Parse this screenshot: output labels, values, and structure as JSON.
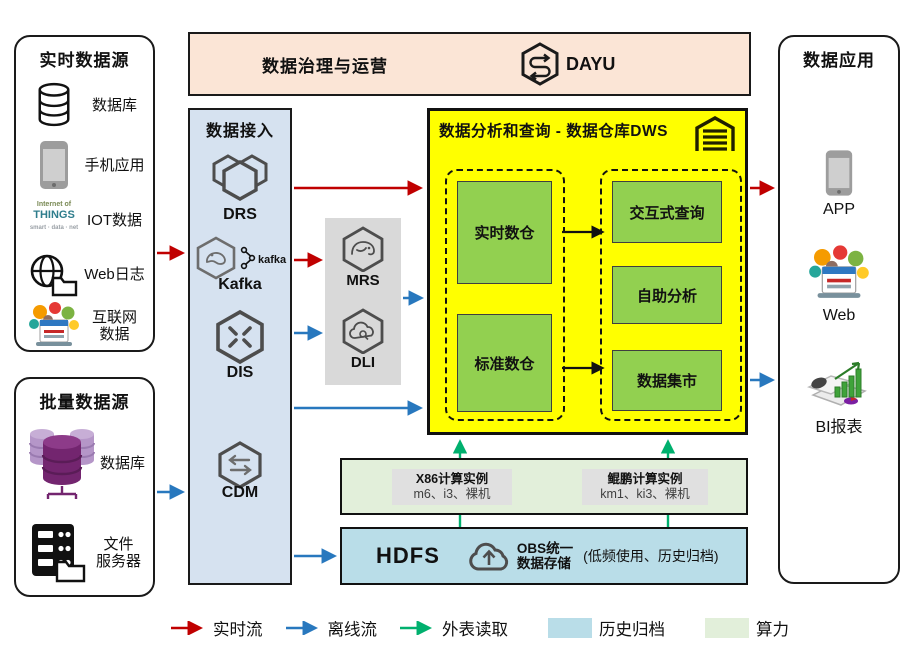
{
  "colors": {
    "realtime_flow": "#c00000",
    "offline_flow": "#2878be",
    "external_read": "#00b06e",
    "archive_fill": "#b9dde8",
    "compute_fill": "#e2efda",
    "dws_fill": "#ffff00",
    "warehouse_green": "#92d050",
    "ingestion_fill": "#d6e2f0",
    "banner_fill": "#fbe5d6",
    "processing_fill": "#d9d9d9"
  },
  "realtime_sources": {
    "title": "实时数据源",
    "items": [
      {
        "icon": "database-icon",
        "label": "数据库"
      },
      {
        "icon": "mobile-phone-icon",
        "label": "手机应用"
      },
      {
        "icon": "iot-wordcloud-icon",
        "label": "IOT数据"
      },
      {
        "icon": "globe-folder-icon",
        "label": "Web日志"
      },
      {
        "icon": "internet-collage-icon",
        "label_line1": "互联网",
        "label_line2": "数据"
      }
    ]
  },
  "batch_sources": {
    "title": "批量数据源",
    "items": [
      {
        "icon": "purple-database-cluster-icon",
        "label": "数据库"
      },
      {
        "icon": "file-server-icon",
        "label_line1": "文件",
        "label_line2": "服务器"
      }
    ]
  },
  "governance": {
    "title": "数据治理与运营",
    "product": "DAYU"
  },
  "ingestion": {
    "title": "数据接入",
    "services": [
      {
        "name": "DRS"
      },
      {
        "name": "Kafka",
        "badge": "kafka"
      },
      {
        "name": "DIS"
      },
      {
        "name": "CDM"
      }
    ]
  },
  "processing": {
    "services": [
      {
        "name": "MRS"
      },
      {
        "name": "DLI"
      }
    ]
  },
  "dws": {
    "title": "数据分析和查询 - 数据仓库DWS",
    "warehouses": [
      "实时数仓",
      "标准数仓"
    ],
    "services": [
      "交互式查询",
      "自助分析",
      "数据集市"
    ]
  },
  "applications": {
    "title": "数据应用",
    "items": [
      {
        "icon": "mobile-phone-icon",
        "label": "APP"
      },
      {
        "icon": "web-collage-icon",
        "label": "Web"
      },
      {
        "icon": "bi-chart-icon",
        "label": "BI报表"
      }
    ]
  },
  "compute": {
    "instances": [
      {
        "name": "X86计算实例",
        "specs": "m6、i3、裸机"
      },
      {
        "name": "鲲鹏计算实例",
        "specs": "km1、ki3、裸机"
      }
    ]
  },
  "storage": {
    "hdfs": "HDFS",
    "obs_line1": "OBS统一",
    "obs_line2": "数据存储",
    "note": "(低频使用、历史归档)"
  },
  "iot_words": {
    "line1": "Internet of",
    "line2": "THINGS",
    "line3": "smart · data · net"
  },
  "legend": {
    "realtime": "实时流",
    "offline": "离线流",
    "external": "外表读取",
    "archive": "历史归档",
    "compute": "算力"
  }
}
